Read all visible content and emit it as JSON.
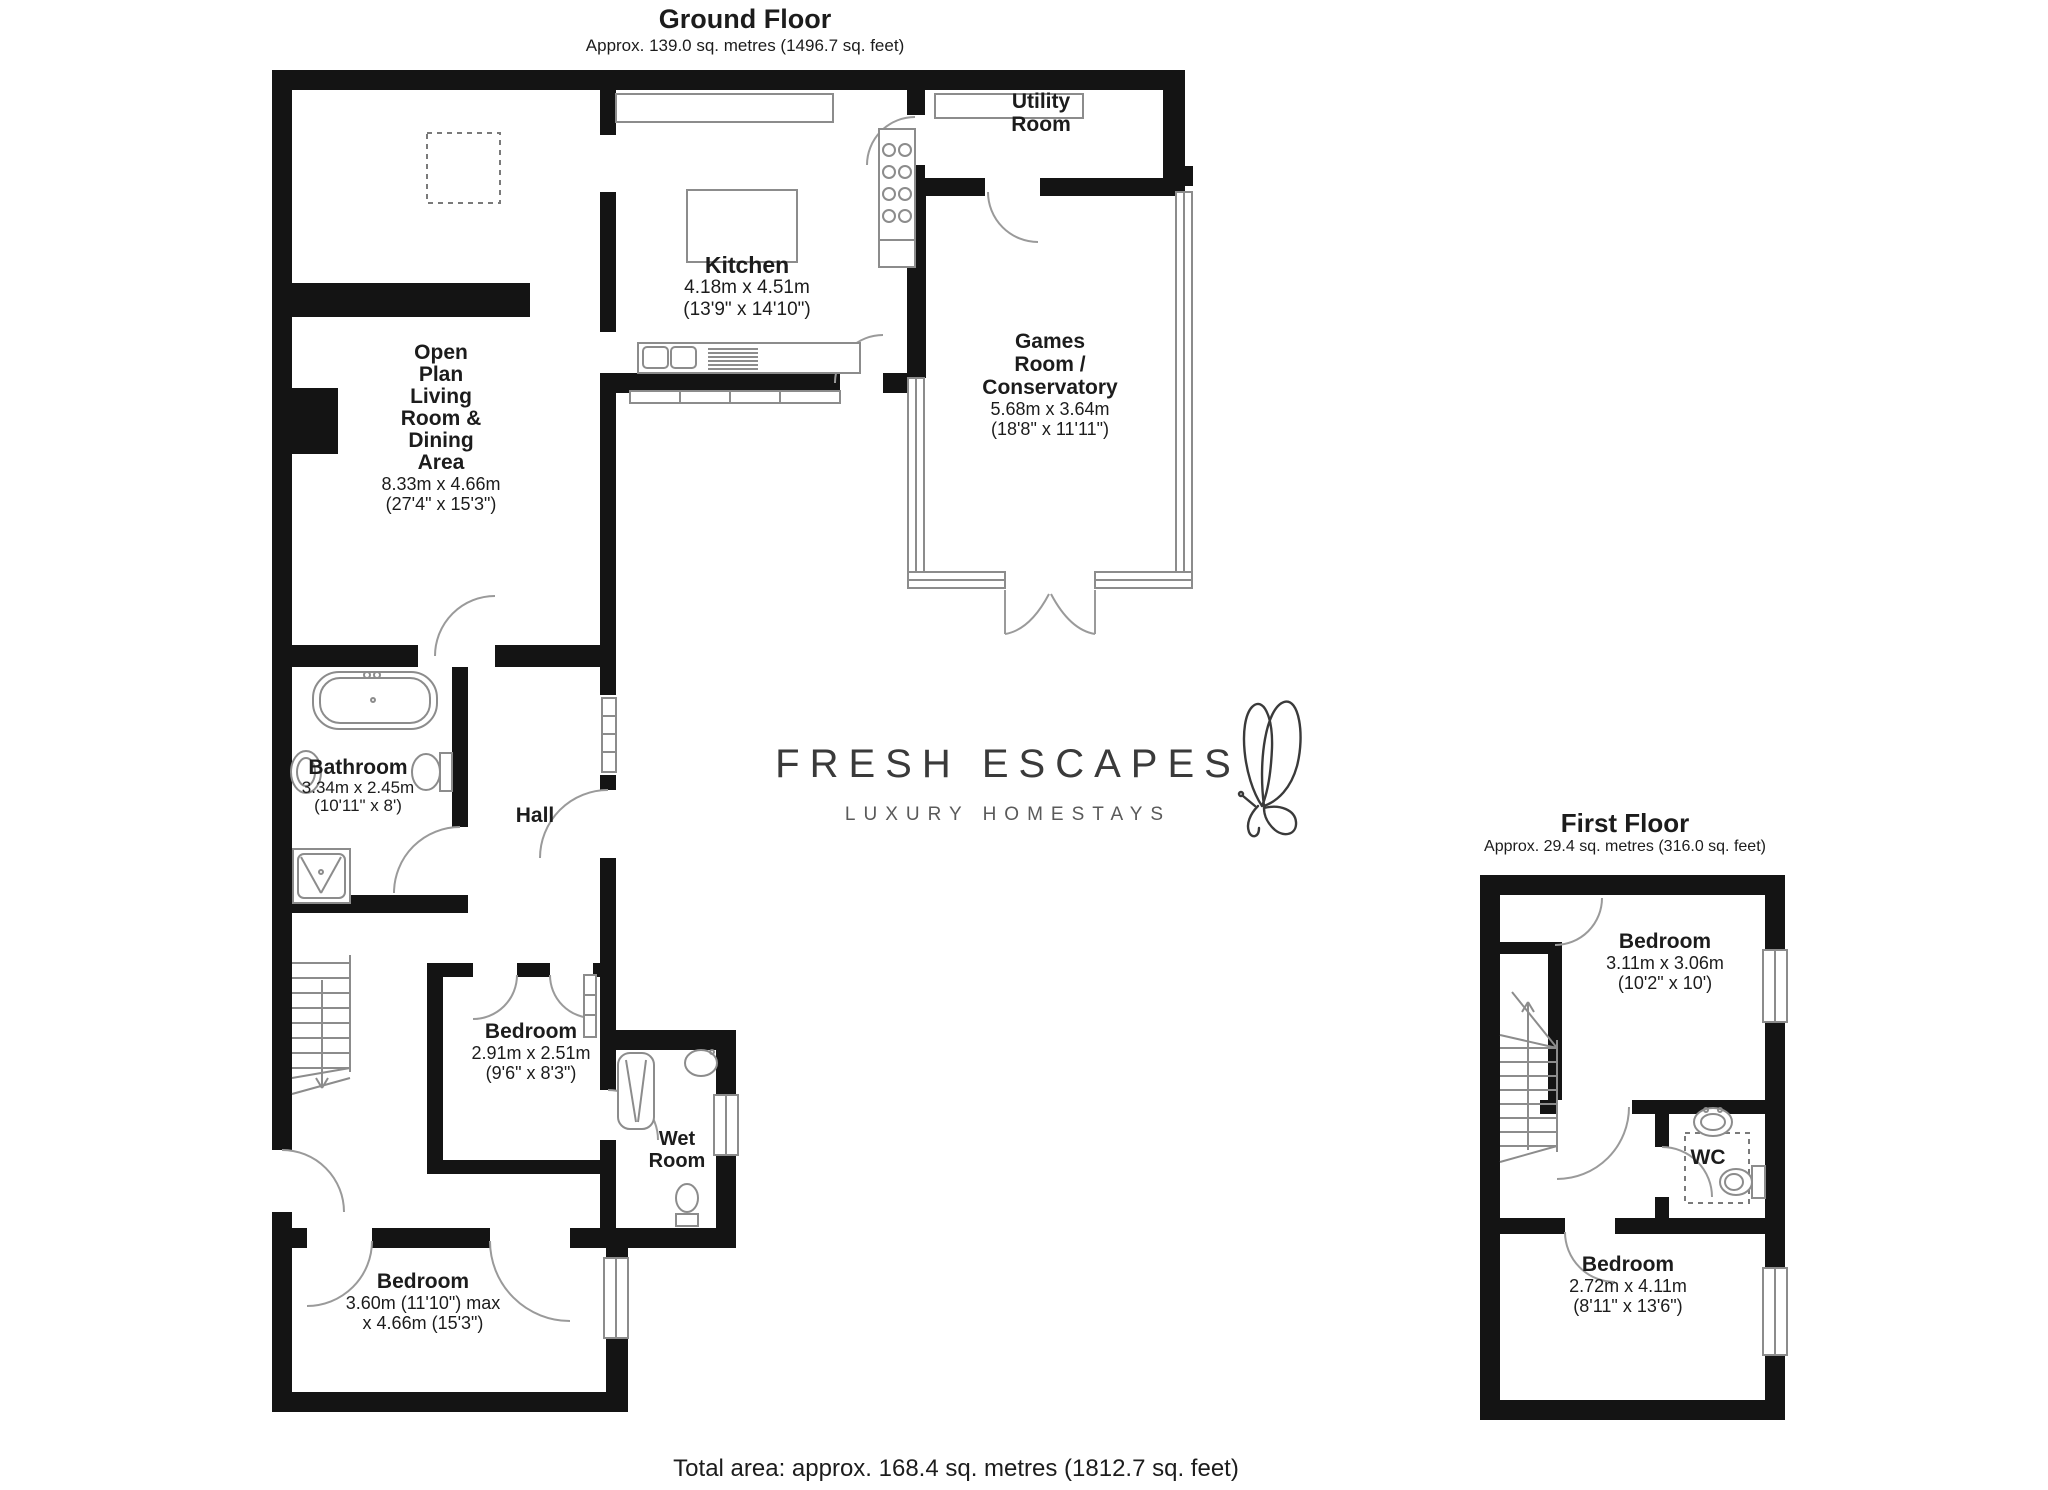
{
  "ground_floor": {
    "title": "Ground Floor",
    "subtitle": "Approx. 139.0 sq. metres (1496.7 sq. feet)",
    "utility": {
      "lines": [
        "Utility",
        "Room"
      ]
    },
    "kitchen": {
      "name": "Kitchen",
      "dims": [
        "4.18m x 4.51m",
        "(13'9\" x 14'10\")"
      ]
    },
    "games_room": {
      "lines": [
        "Games",
        "Room /",
        "Conservatory"
      ],
      "dims": [
        "5.68m x 3.64m",
        "(18'8\" x 11'11\")"
      ]
    },
    "open_plan": {
      "lines": [
        "Open",
        "Plan",
        "Living",
        "Room &",
        "Dining",
        "Area"
      ],
      "dims": [
        "8.33m x 4.66m",
        "(27'4\" x 15'3\")"
      ]
    },
    "bathroom": {
      "name": "Bathroom",
      "dims": [
        "3.34m x 2.45m",
        "(10'11\" x 8')"
      ]
    },
    "hall": {
      "name": "Hall"
    },
    "bedroom_small": {
      "name": "Bedroom",
      "dims": [
        "2.91m x 2.51m",
        "(9'6\" x 8'3\")"
      ]
    },
    "wet_room": {
      "lines": [
        "Wet",
        "Room"
      ]
    },
    "bedroom_large": {
      "name": "Bedroom",
      "dims": [
        "3.60m (11'10\") max",
        "x 4.66m (15'3\")"
      ]
    }
  },
  "first_floor": {
    "title": "First Floor",
    "subtitle": "Approx. 29.4 sq. metres (316.0 sq. feet)",
    "bedroom_front": {
      "name": "Bedroom",
      "dims": [
        "3.11m x 3.06m",
        "(10'2\" x 10')"
      ]
    },
    "wc": {
      "name": "WC"
    },
    "bedroom_back": {
      "name": "Bedroom",
      "dims": [
        "2.72m x 4.11m",
        "(8'11\" x 13'6\")"
      ]
    }
  },
  "logo": {
    "brand": "FRESH ESCAPES",
    "tagline": "LUXURY HOMESTAYS"
  },
  "footer": {
    "total_area": "Total area: approx. 168.4 sq. metres (1812.7 sq. feet)"
  },
  "colors": {
    "wall": "#141414",
    "fixture": "#8c8c8c",
    "door": "#9a9a9a",
    "text": "#1c1c1c",
    "logo_text": "#3a3a3a",
    "tagline_text": "#5a5a5a"
  }
}
